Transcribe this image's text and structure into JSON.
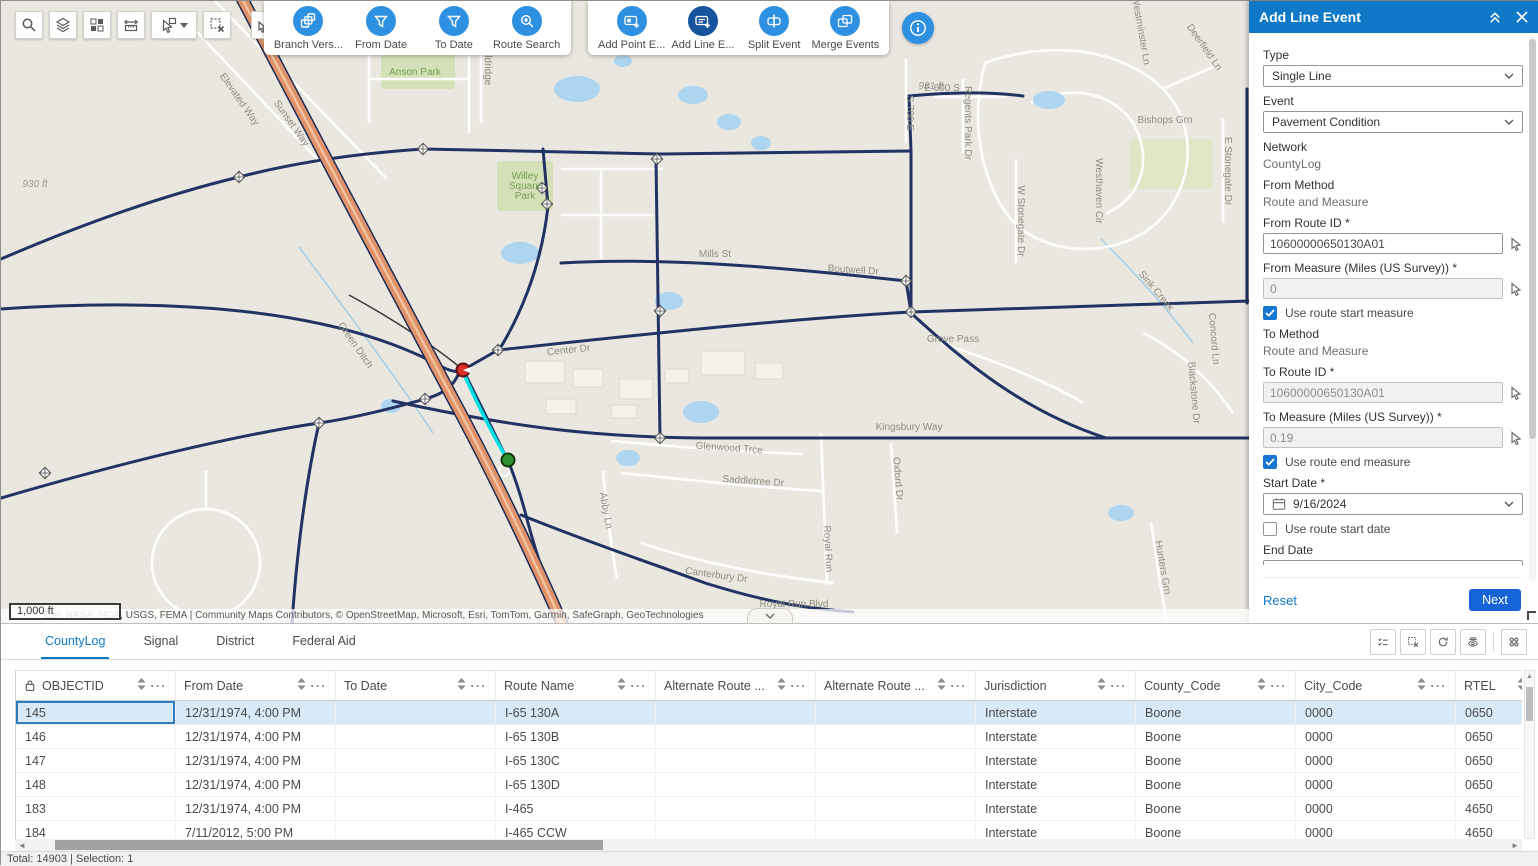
{
  "colors": {
    "accent": "#0f79c8",
    "icon_blue": "#2e90e0",
    "icon_blue_active": "#17549e",
    "next_blue": "#1464d8",
    "selected_row": "#d8e9f8"
  },
  "icons": {
    "search": "magnifier",
    "layers": "stacked-layers",
    "basemap": "grid-blocks",
    "measure": "ruler-arrows",
    "select": "pointer-box",
    "clear_selection": "dashed-box-x",
    "attribute_query": "pointer-table",
    "collapse": "double-chevron-up",
    "close": "x",
    "info": "i-circle",
    "calendar": "calendar",
    "map_pick": "pointer-arrow",
    "lock": "padlock",
    "sort": "up-down-triangles",
    "menu": "ellipsis",
    "show_selection": "checklist",
    "refresh": "circular-arrows",
    "hide_fields": "eye-lines",
    "options": "four-dots"
  },
  "toolbars": {
    "selection_tools": {
      "buttons": [
        {
          "label": "Branch Vers...",
          "icon": "branch-versions-icon",
          "active": false
        },
        {
          "label": "From Date",
          "icon": "from-date-filter-icon",
          "active": false
        },
        {
          "label": "To Date",
          "icon": "to-date-filter-icon",
          "active": false
        },
        {
          "label": "Route Search",
          "icon": "route-search-icon",
          "active": false
        }
      ]
    },
    "event_tools": {
      "buttons": [
        {
          "label": "Add Point E...",
          "icon": "add-point-event-icon",
          "active": false
        },
        {
          "label": "Add Line E...",
          "icon": "add-line-event-icon",
          "active": true
        },
        {
          "label": "Split Event",
          "icon": "split-event-icon",
          "active": false
        },
        {
          "label": "Merge Events",
          "icon": "merge-events-icon",
          "active": false
        }
      ]
    }
  },
  "map": {
    "scale_label": "1,000 ft",
    "attribution": "Esri, NASA, NGA, USGS, FEMA | Community Maps Contributors, © OpenStreetMap, Microsoft, Esri, TomTom, Garmin, SafeGraph, GeoTechnologies",
    "labels": [
      {
        "t": "Elevated Way",
        "x": 236,
        "y": 100,
        "r": 55
      },
      {
        "t": "Sunset Way",
        "x": 288,
        "y": 124,
        "r": 55
      },
      {
        "t": "Anson Park",
        "x": 414,
        "y": 74,
        "k": "g"
      },
      {
        "t": "Willey",
        "x": 524,
        "y": 178,
        "k": "g"
      },
      {
        "t": "Square",
        "x": 524,
        "y": 188,
        "k": "g"
      },
      {
        "t": "Park",
        "x": 524,
        "y": 198,
        "k": "g"
      },
      {
        "t": "930 ft",
        "x": 34,
        "y": 186,
        "k": "e"
      },
      {
        "t": "931 ft",
        "x": 930,
        "y": 88,
        "k": "e"
      },
      {
        "t": "Aldridge",
        "x": 484,
        "y": 66,
        "r": 90
      },
      {
        "t": "Mills St",
        "x": 714,
        "y": 256
      },
      {
        "t": "Boutwell Dr",
        "x": 852,
        "y": 272,
        "r": 4
      },
      {
        "t": "Center Dr",
        "x": 568,
        "y": 352,
        "r": -6
      },
      {
        "t": "Grove Pass",
        "x": 952,
        "y": 341
      },
      {
        "t": "Kingsbury Way",
        "x": 908,
        "y": 429
      },
      {
        "t": "Glenwood Trce",
        "x": 728,
        "y": 450,
        "r": 4
      },
      {
        "t": "Saddletree Dr",
        "x": 752,
        "y": 483,
        "r": 4
      },
      {
        "t": "Abby Ln",
        "x": 602,
        "y": 510,
        "r": 80
      },
      {
        "t": "Canterbury Dr",
        "x": 715,
        "y": 577,
        "r": 8
      },
      {
        "t": "Royal Run Blvd",
        "x": 793,
        "y": 606
      },
      {
        "t": "Royal Run",
        "x": 824,
        "y": 548,
        "r": 87
      },
      {
        "t": "Oxford Dr",
        "x": 894,
        "y": 478,
        "r": 85
      },
      {
        "t": "Hunters Grn",
        "x": 1159,
        "y": 567,
        "r": 80
      },
      {
        "t": "S 700 E",
        "x": 906,
        "y": 112,
        "r": 90
      },
      {
        "t": "E 600 S",
        "x": 941,
        "y": 90
      },
      {
        "t": "Regents Park Dr",
        "x": 964,
        "y": 122,
        "r": 90
      },
      {
        "t": "Westhaven Cir",
        "x": 1095,
        "y": 190,
        "r": 90
      },
      {
        "t": "W Stonegate Dr",
        "x": 1017,
        "y": 220,
        "r": 90
      },
      {
        "t": "E Stonegate Dr",
        "x": 1224,
        "y": 170,
        "r": 90
      },
      {
        "t": "Bishops Grn",
        "x": 1164,
        "y": 122
      },
      {
        "t": "Deerfield Ln",
        "x": 1201,
        "y": 48,
        "r": 55
      },
      {
        "t": "Westminster Ln",
        "x": 1137,
        "y": 30,
        "r": 80
      },
      {
        "t": "Blackstone Dr",
        "x": 1190,
        "y": 392,
        "r": 85
      },
      {
        "t": "Concord Ln",
        "x": 1210,
        "y": 338,
        "r": 85
      },
      {
        "t": "Sink Creek",
        "x": 1153,
        "y": 292,
        "r": 50
      },
      {
        "t": "Green Ditch",
        "x": 352,
        "y": 346,
        "r": 55
      }
    ]
  },
  "panel": {
    "title": "Add Line Event",
    "type_label": "Type",
    "type_value": "Single Line",
    "event_label": "Event",
    "event_value": "Pavement Condition",
    "network_label": "Network",
    "network_value": "CountyLog",
    "from_method_label": "From Method",
    "from_method_value": "Route and Measure",
    "from_route_label": "From Route ID *",
    "from_route_value": "10600000650130A01",
    "from_measure_label": "From Measure (Miles (US Survey)) *",
    "from_measure_value": "0",
    "use_route_start_measure": "Use route start measure",
    "to_method_label": "To Method",
    "to_method_value": "Route and Measure",
    "to_route_label": "To Route ID *",
    "to_route_value": "10600000650130A01",
    "to_measure_label": "To Measure (Miles (US Survey)) *",
    "to_measure_value": "0.19",
    "use_route_end_measure": "Use route end measure",
    "start_date_label": "Start Date *",
    "start_date_value": "9/16/2024",
    "use_route_start_date": "Use route start date",
    "end_date_label": "End Date",
    "end_date_placeholder": "MM/DD/YYYY",
    "use_route_end_date": "Use route end date",
    "reset_label": "Reset",
    "next_label": "Next"
  },
  "table": {
    "tabs": [
      {
        "label": "CountyLog",
        "active": true
      },
      {
        "label": "Signal",
        "active": false
      },
      {
        "label": "District",
        "active": false
      },
      {
        "label": "Federal Aid",
        "active": false
      }
    ],
    "columns": [
      {
        "label": "OBJECTID",
        "locked": true
      },
      {
        "label": "From Date"
      },
      {
        "label": "To Date"
      },
      {
        "label": "Route Name"
      },
      {
        "label": "Alternate Route ..."
      },
      {
        "label": "Alternate Route ..."
      },
      {
        "label": "Jurisdiction"
      },
      {
        "label": "County_Code"
      },
      {
        "label": "City_Code"
      },
      {
        "label": "RTEL"
      }
    ],
    "rows": [
      [
        "145",
        "12/31/1974, 4:00 PM",
        "",
        "I-65 130A",
        "",
        "",
        "Interstate",
        "Boone",
        "0000",
        "0650"
      ],
      [
        "146",
        "12/31/1974, 4:00 PM",
        "",
        "I-65 130B",
        "",
        "",
        "Interstate",
        "Boone",
        "0000",
        "0650"
      ],
      [
        "147",
        "12/31/1974, 4:00 PM",
        "",
        "I-65 130C",
        "",
        "",
        "Interstate",
        "Boone",
        "0000",
        "0650"
      ],
      [
        "148",
        "12/31/1974, 4:00 PM",
        "",
        "I-65 130D",
        "",
        "",
        "Interstate",
        "Boone",
        "0000",
        "0650"
      ],
      [
        "183",
        "12/31/1974, 4:00 PM",
        "",
        "I-465",
        "",
        "",
        "Interstate",
        "Boone",
        "0000",
        "4650"
      ],
      [
        "184",
        "7/11/2012, 5:00 PM",
        "",
        "I-465 CCW",
        "",
        "",
        "Interstate",
        "Boone",
        "0000",
        "4650"
      ]
    ],
    "selected_row_index": 0,
    "status": "Total: 14903 | Selection: 1"
  }
}
